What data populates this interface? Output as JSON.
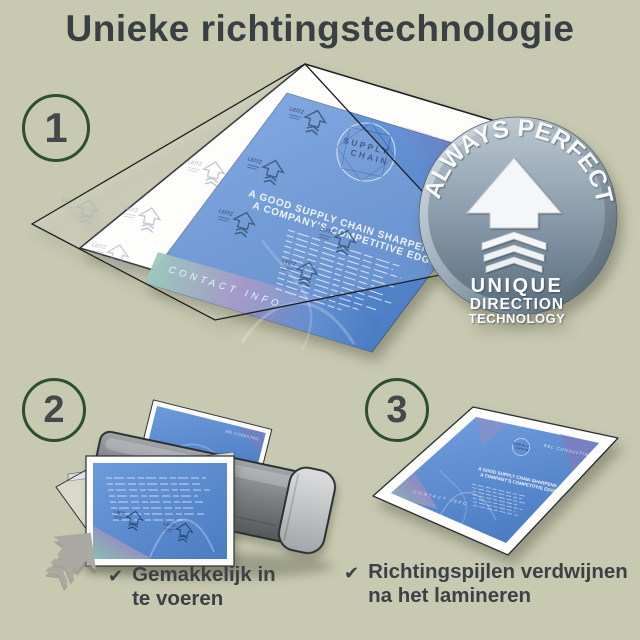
{
  "title": "Unieke richtingstechnologie",
  "steps": {
    "one": "1",
    "two": "2",
    "three": "3"
  },
  "badge": {
    "arc_text": "ALWAYS PERFECT!",
    "line1": "UNIQUE",
    "line2": "DIRECTION",
    "line3": "TECHNOLOGY"
  },
  "doc": {
    "brand": "BBL CONSULTING",
    "logo_line1": "SUPPLY",
    "logo_line2": "CHAIN",
    "heading_line1": "A GOOD SUPPLY CHAIN SHARPENS",
    "heading_line2": "A COMPANY'S COMPETITIVE EDGE.",
    "footer": "CONTACT INFO",
    "arrow_label": "LEITZ"
  },
  "captions": {
    "one_check": "✔",
    "one_line1": "Gemakkelijk in",
    "one_line2": "te voeren",
    "two_check": "✔",
    "two_line1": "Richtingspijlen verdwijnen",
    "two_line2": "na het lamineren"
  },
  "colors": {
    "background": "#c8c9b1",
    "accent_green": "#2d4f2c",
    "text": "#3c4145",
    "doc_blue": "#5b8ed2",
    "badge_steel": "#8a9dac"
  }
}
